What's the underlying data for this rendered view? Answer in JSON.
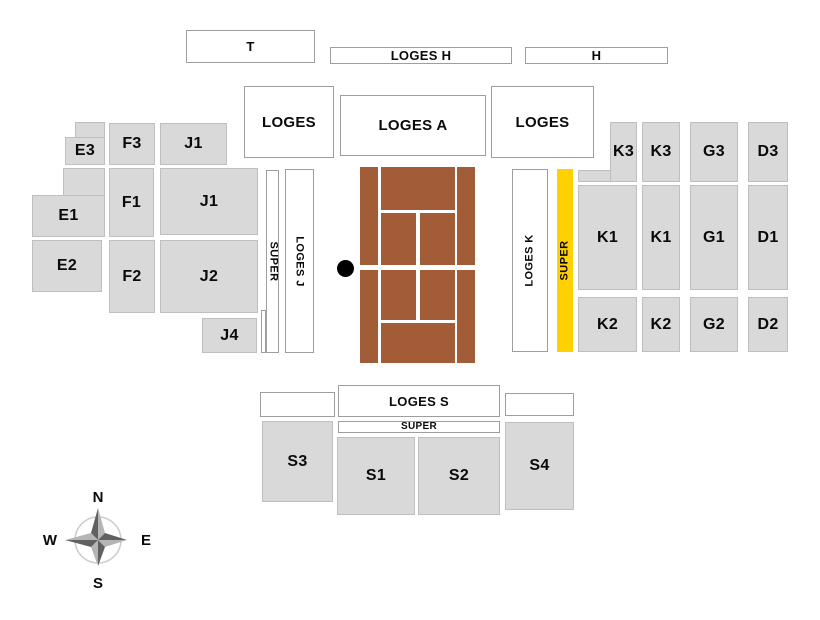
{
  "colors": {
    "stand_gray": "#D9D9D9",
    "stand_border": "#BFBFBF",
    "loge_border": "#9E9E9E",
    "court_brown": "#A35C38",
    "highlight_yellow": "#FFD100",
    "dot_black": "#000000",
    "label_black": "#0A0A0A",
    "compass_dark": "#606060",
    "compass_light": "#B5B5B5",
    "compass_circle": "#CCCCCC"
  },
  "sections": {
    "stands": [
      {
        "id": "e3",
        "label": "E3"
      },
      {
        "id": "e1",
        "label": "E1"
      },
      {
        "id": "e2",
        "label": "E2"
      },
      {
        "id": "f3",
        "label": "F3"
      },
      {
        "id": "f1",
        "label": "F1"
      },
      {
        "id": "f2",
        "label": "F2"
      },
      {
        "id": "j1-top",
        "label": "J1"
      },
      {
        "id": "j1",
        "label": "J1"
      },
      {
        "id": "j2",
        "label": "J2"
      },
      {
        "id": "j4",
        "label": "J4"
      },
      {
        "id": "k3-w",
        "label": "K3"
      },
      {
        "id": "k3-e",
        "label": "K3"
      },
      {
        "id": "g3",
        "label": "G3"
      },
      {
        "id": "d3",
        "label": "D3"
      },
      {
        "id": "k1-w",
        "label": "K1"
      },
      {
        "id": "k1-e",
        "label": "K1"
      },
      {
        "id": "g1",
        "label": "G1"
      },
      {
        "id": "d1",
        "label": "D1"
      },
      {
        "id": "k2-w",
        "label": "K2"
      },
      {
        "id": "k2-e",
        "label": "K2"
      },
      {
        "id": "g2",
        "label": "G2"
      },
      {
        "id": "d2",
        "label": "D2"
      },
      {
        "id": "s3",
        "label": "S3"
      },
      {
        "id": "s1",
        "label": "S1"
      },
      {
        "id": "s2",
        "label": "S2"
      },
      {
        "id": "s4",
        "label": "S4"
      }
    ],
    "loges": [
      {
        "id": "t",
        "label": "T"
      },
      {
        "id": "loges-h",
        "label": "LOGES H"
      },
      {
        "id": "h",
        "label": "H"
      },
      {
        "id": "loges-nw",
        "label": "LOGES"
      },
      {
        "id": "loges-a",
        "label": "LOGES A"
      },
      {
        "id": "loges-ne",
        "label": "LOGES"
      },
      {
        "id": "box-sw",
        "label": ""
      },
      {
        "id": "loges-s",
        "label": "LOGES S"
      },
      {
        "id": "box-se",
        "label": ""
      },
      {
        "id": "super-s",
        "label": "SUPER"
      }
    ],
    "strips": [
      {
        "id": "super-w",
        "label": "SUPER",
        "highlighted": false
      },
      {
        "id": "loges-j",
        "label": "LOGES J",
        "highlighted": false
      },
      {
        "id": "loges-k",
        "label": "LOGES K",
        "highlighted": false
      },
      {
        "id": "super-e",
        "label": "SUPER",
        "highlighted": true
      }
    ]
  },
  "compass": {
    "north": "N",
    "south": "S",
    "east": "E",
    "west": "W"
  }
}
